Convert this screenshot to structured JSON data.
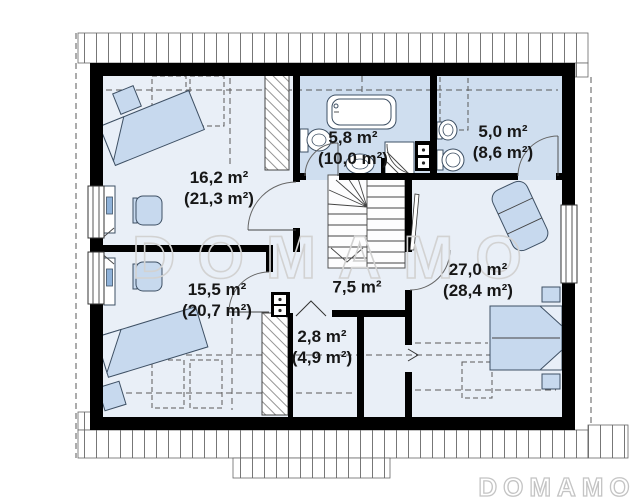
{
  "plan": {
    "watermark": "DOMAMO",
    "brand_logo": "DOMAMO",
    "rooms": [
      {
        "id": "bedroom-top-left",
        "area": "16,2 m²",
        "area_total": "(21,3 m²)"
      },
      {
        "id": "bathroom",
        "area": "5,8 m²",
        "area_total": "(10,0 m²)"
      },
      {
        "id": "wc",
        "area": "5,0 m²",
        "area_total": "(8,6 m²)"
      },
      {
        "id": "bedroom-right",
        "area": "27,0 m²",
        "area_total": "(28,4 m²)"
      },
      {
        "id": "hallway-stairs",
        "area": "7,5 m²",
        "area_total": ""
      },
      {
        "id": "bedroom-bottom-left",
        "area": "15,5 m²",
        "area_total": "(20,7 m²)"
      },
      {
        "id": "closet",
        "area": "2,8 m²",
        "area_total": "(4,9 m²)"
      }
    ],
    "colors": {
      "wall": "#000000",
      "floor": "#e9eff7",
      "wet_room_floor": "#cfdeef",
      "furniture": "#c7d9ee",
      "watermark": "#d2d2d2"
    }
  }
}
